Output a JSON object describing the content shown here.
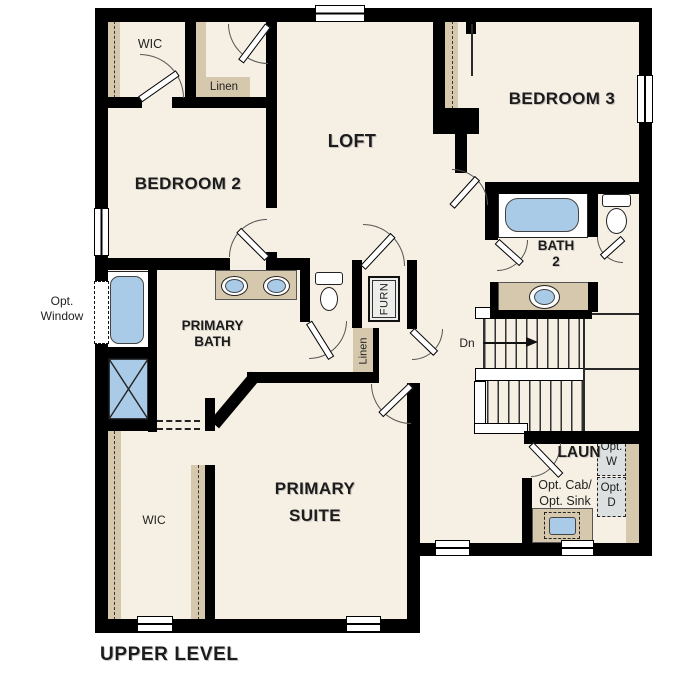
{
  "plan_title": "UPPER LEVEL",
  "colors": {
    "floor": "#f6efe3",
    "wall": "#000000",
    "casework_tan": "#d6c8ad",
    "fixture_blue": "#a9cbe8",
    "appliance_gray": "#dce0e1"
  },
  "rooms": {
    "wic_upper": {
      "label": "WIC"
    },
    "linen_upper": {
      "label": "Linen"
    },
    "bedroom2": {
      "label": "BEDROOM 2"
    },
    "loft": {
      "label": "LOFT"
    },
    "bedroom3": {
      "label": "BEDROOM 3"
    },
    "bath2": {
      "line1": "BATH",
      "line2": "2"
    },
    "primary_bath": {
      "line1": "PRIMARY",
      "line2": "BATH"
    },
    "furnace": {
      "label": "FURN"
    },
    "linen_mid": {
      "label": "Linen"
    },
    "primary_suite": {
      "line1": "PRIMARY",
      "line2": "SUITE"
    },
    "wic_primary": {
      "label": "WIC"
    },
    "laundry": {
      "label": "LAUN"
    }
  },
  "annotations": {
    "opt_window": {
      "line1": "Opt.",
      "line2": "Window"
    },
    "stairs": {
      "down": "Dn"
    },
    "opt_washer": {
      "line1": "Opt.",
      "line2": "W"
    },
    "opt_dryer": {
      "line1": "Opt.",
      "line2": "D"
    },
    "opt_cabinet": {
      "line1": "Opt. Cab/",
      "line2": "Opt. Sink"
    }
  }
}
